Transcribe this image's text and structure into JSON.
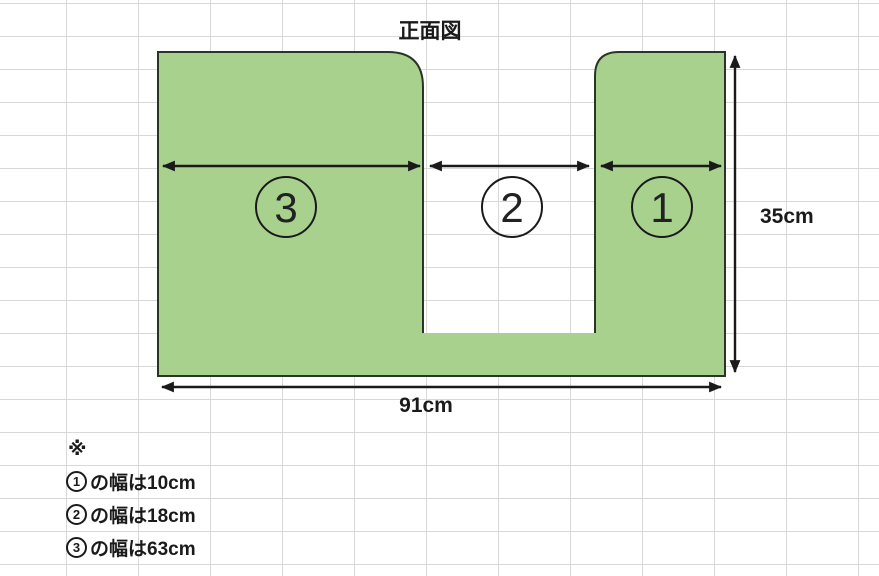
{
  "colors": {
    "shape_fill": "#A9D18E",
    "shape_outline": "#2B3524",
    "line": "#1A1A1A",
    "grid_line": "#D8D8D8",
    "text": "#1A1A1A"
  },
  "diagram": {
    "title": "正面図",
    "height_label": "35cm",
    "width_label": "91cm",
    "sections": [
      {
        "label": "3"
      },
      {
        "label": "2"
      },
      {
        "label": "1"
      }
    ]
  },
  "notes": {
    "marker": "※",
    "items": [
      {
        "num": "1",
        "text": "の幅は10cm"
      },
      {
        "num": "2",
        "text": "の幅は18cm"
      },
      {
        "num": "3",
        "text": "の幅は63cm"
      }
    ]
  }
}
